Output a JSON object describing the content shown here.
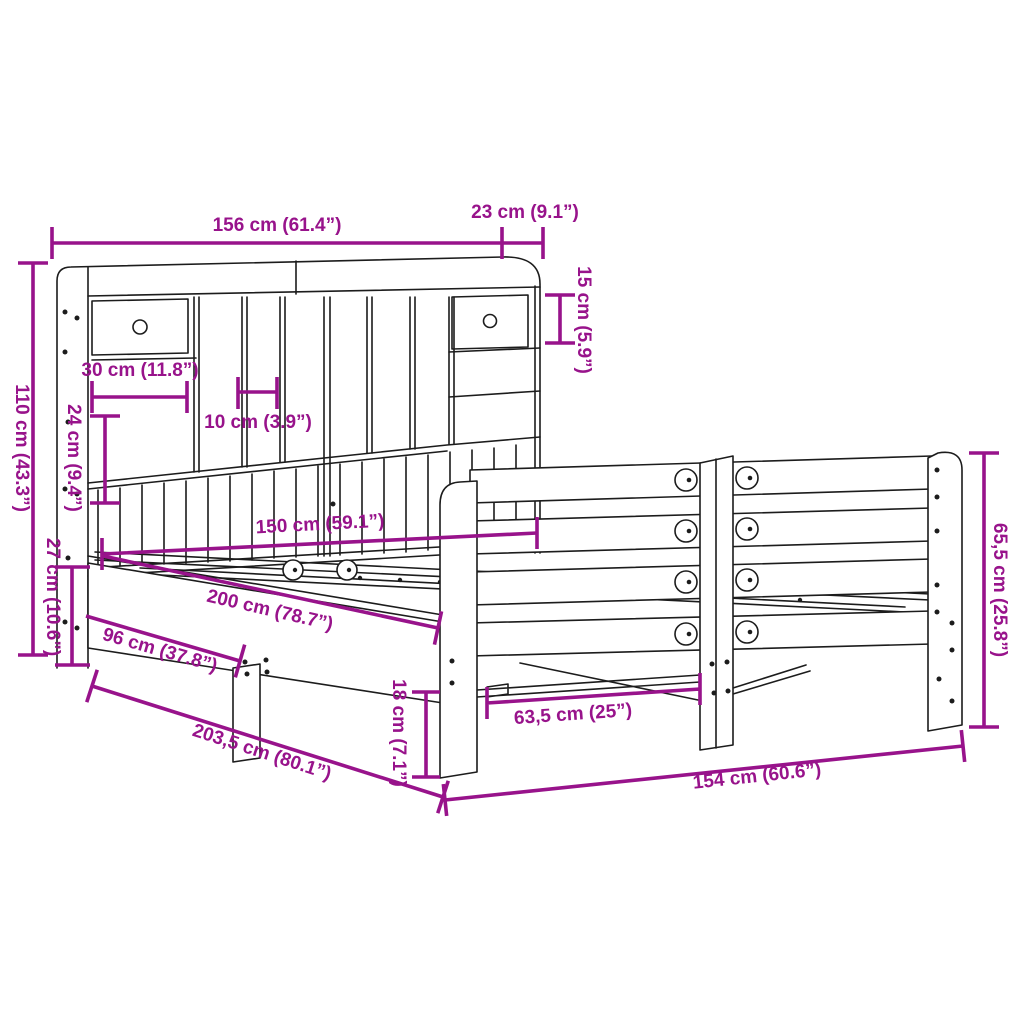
{
  "diagram": {
    "kind": "furniture dimension diagram",
    "subject": "bookcase bed frame with headboard storage and footboard",
    "background_color": "#ffffff",
    "line_color": "#1c1c1c",
    "accent_color": "#98138B"
  },
  "dims": [
    {
      "id": "headboard-width",
      "label": "156 cm (61.4”)"
    },
    {
      "id": "headboard-depth",
      "label": "23 cm (9.1”)"
    },
    {
      "id": "top-shelf-height",
      "label": "15 cm (5.9”)"
    },
    {
      "id": "headboard-height",
      "label": "110 cm (43.3”)"
    },
    {
      "id": "drawer-width",
      "label": "30 cm (11.8”)"
    },
    {
      "id": "cubby-width",
      "label": "10 cm (3.9”)"
    },
    {
      "id": "slat-panel-height",
      "label": "24 cm (9.4”)"
    },
    {
      "id": "inner-width",
      "label": "150 cm (59.1”)"
    },
    {
      "id": "side-rail-height",
      "label": "27 cm (10.6”)"
    },
    {
      "id": "inner-length",
      "label": "200 cm (78.7”)"
    },
    {
      "id": "leg-distance",
      "label": "96 cm (37.8”)"
    },
    {
      "id": "total-length",
      "label": "203,5 cm (80.1”)"
    },
    {
      "id": "under-bed-clearance",
      "label": "18 cm (7.1”)"
    },
    {
      "id": "support-spacing",
      "label": "63,5 cm (25”)"
    },
    {
      "id": "footboard-width",
      "label": "154 cm (60.6”)"
    },
    {
      "id": "footboard-height",
      "label": "65,5 cm (25.8”)"
    }
  ]
}
